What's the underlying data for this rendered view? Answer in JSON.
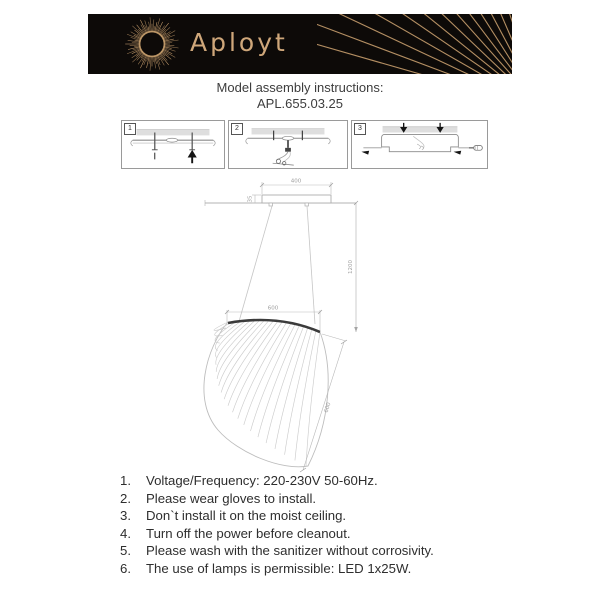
{
  "brand": {
    "logo_text": "Aployt"
  },
  "title": {
    "line1": "Model assembly instructions:",
    "model": "APL.655.03.25"
  },
  "steps": {
    "labels": [
      "1",
      "2",
      "3"
    ]
  },
  "drawing": {
    "dims": {
      "canopy_width": "400",
      "canopy_height": "35",
      "suspension_height": "1200",
      "shade_width": "600",
      "shade_height": "600"
    }
  },
  "instructions": {
    "items": [
      {
        "num": "1.",
        "text": "Voltage/Frequency: 220-230V 50-60Hz."
      },
      {
        "num": "2.",
        "text": "Please wear gloves to install."
      },
      {
        "num": "3.",
        "text": "Don`t install it on the moist ceiling."
      },
      {
        "num": "4.",
        "text": "Turn off the power before cleanout."
      },
      {
        "num": "5.",
        "text": "Please wash with the sanitizer without corrosivity."
      },
      {
        "num": "6.",
        "text": "The use of lamps is permissible: LED 1x25W."
      }
    ]
  },
  "colors": {
    "banner_bg": "#0d0a08",
    "gold": "#c79e6d",
    "drawing_line": "#b3b3b3",
    "text": "#333333"
  }
}
